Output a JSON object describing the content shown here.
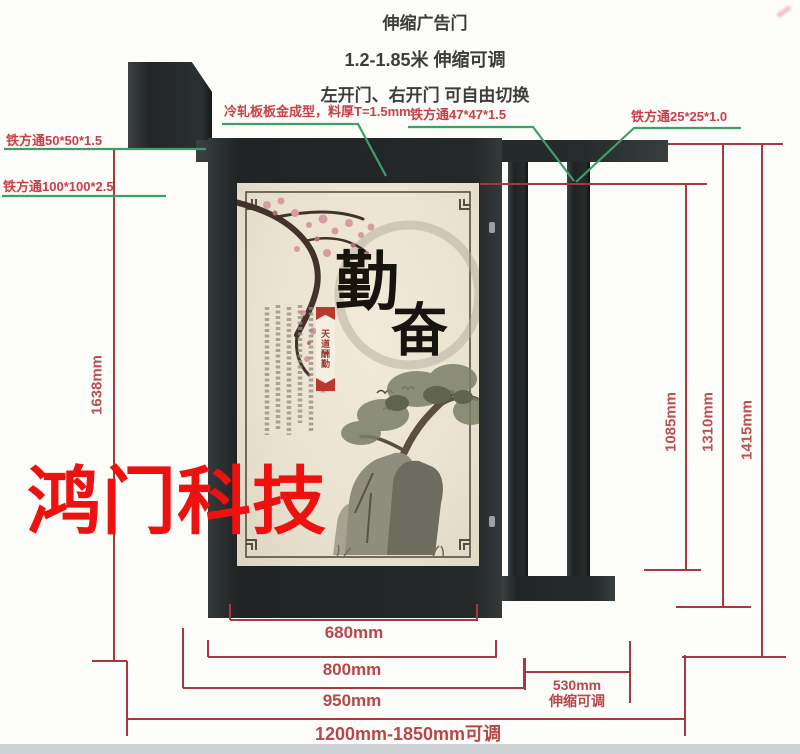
{
  "title": {
    "line1": "伸缩广告门",
    "line2": "1.2-1.85米 伸缩可调",
    "line3": "左开门、右开门 可自由切换"
  },
  "material_callouts": {
    "left_top": "铁方通50*50*1.5",
    "left_bottom": "铁方通100*100*2.5",
    "panel_sheet": "冷轧板板金成型，料厚T=1.5mm",
    "door_frame": "铁方通47*47*1.5",
    "fence_bar": "铁方通25*25*1.0"
  },
  "dimensions": {
    "gate_height": "1638mm",
    "bar_section_height": "1085mm",
    "mid_height": "1310mm",
    "post_height": "1415mm",
    "panel_width": "680mm",
    "door_width": "800mm",
    "door_span": "950mm",
    "extension_width": "530mm",
    "extension_note": "伸缩可调",
    "total_width": "1200mm-1850mm可调"
  },
  "watermark": "鸿门科技",
  "ad_panel": {
    "calligraphy_char_1": "勤",
    "calligraphy_char_2": "奋",
    "seal_ribbon_text": "天道酬勤"
  },
  "colors": {
    "dimension_line": "#a23a3f",
    "dimension_text": "#b8474c",
    "callout_text": "#c9404a",
    "leader_line": "#3f9e6a",
    "watermark_red": "#ed1110",
    "gate_dark": "#232728",
    "panel_beige": "#eae3d2",
    "footer_strip": "#cdd2d6"
  }
}
